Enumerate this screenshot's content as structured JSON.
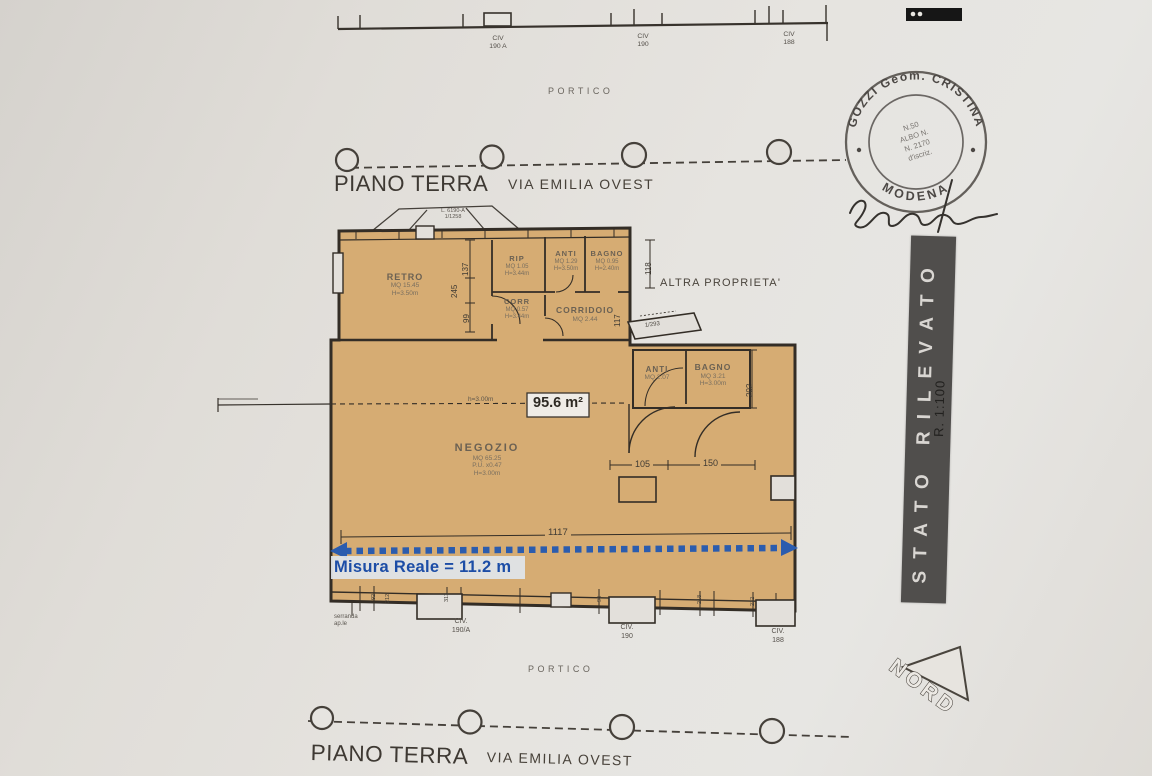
{
  "colors": {
    "paper": "#e3e0db",
    "plan_fill": "#d6ac73",
    "ink": "#332d26",
    "blue": "#2b5cae",
    "banner_bg": "#504e4c"
  },
  "top": {
    "civ": [
      {
        "l1": "CIV",
        "l2": "190 A"
      },
      {
        "l1": "CIV",
        "l2": "190"
      },
      {
        "l1": "CIV",
        "l2": "188"
      }
    ],
    "portico": "PORTICO",
    "piano_terra": "PIANO TERRA",
    "via": "VIA EMILIA OVEST"
  },
  "stamp": {
    "arc_top": "GOZZI Geom. CRISTINA",
    "arc_bottom": "MODENA",
    "center": [
      "N.50",
      "ALBO N.",
      "N. 2170",
      "d'iscriz."
    ]
  },
  "side": {
    "banner": "STATO RILEVATO",
    "scale": "R. 1:100",
    "nord": "NORD"
  },
  "plan": {
    "canopy_l1": "L. 6190-A",
    "canopy_l2": "1/1258",
    "flap": "1/293",
    "altra_proprieta": "ALTRA PROPRIETA'",
    "height_label": "h=3.00m",
    "area_box": "95.6 m²",
    "misura_reale": "Misura Reale = 11.2 m",
    "serranda_l1": "serranda",
    "serranda_l2": "ap.le",
    "rooms": {
      "retro": {
        "name": "RETRO",
        "area": "MQ 15.45",
        "h": "H=3.50m"
      },
      "rip": {
        "name": "RIP",
        "area": "MQ 1.05",
        "h": "H=3.44m"
      },
      "anti_top": {
        "name": "ANTI",
        "area": "MQ 1.29",
        "h": "H=3.50m"
      },
      "bagno_top": {
        "name": "BAGNO",
        "area": "MQ 0.95",
        "h": "H=2.40m"
      },
      "corr": {
        "name": "CORR",
        "area": "MQ 0.57",
        "h": "H=3.44m"
      },
      "corridoio": {
        "name": "CORRIDOIO",
        "area": "MQ 2.44"
      },
      "anti_mid": {
        "name": "ANTI",
        "area": "MQ 2.07"
      },
      "bagno_mid": {
        "name": "BAGNO",
        "area": "MQ 3.21",
        "h": "H=3.00m"
      },
      "negozio": {
        "name": "NEGOZIO",
        "area": "MQ 65.25",
        "l3": "P.U. x0.47",
        "h": "H=3.00m"
      }
    },
    "dims": {
      "v1": "137",
      "v2": "245",
      "v3": "99",
      "v4": "118",
      "v5": "117",
      "v6": "202",
      "h1": "105",
      "h2": "150",
      "total": "1117"
    },
    "ticks": [
      "92",
      "212",
      "313",
      "98",
      "218",
      "212"
    ],
    "civ_bottom": [
      {
        "l1": "CIV.",
        "l2": "190/A"
      },
      {
        "l1": "CIV.",
        "l2": "190"
      },
      {
        "l1": "CIV.",
        "l2": "188"
      }
    ]
  },
  "bottom": {
    "portico": "PORTICO",
    "piano_terra": "PIANO TERRA",
    "via": "VIA EMILIA OVEST"
  }
}
